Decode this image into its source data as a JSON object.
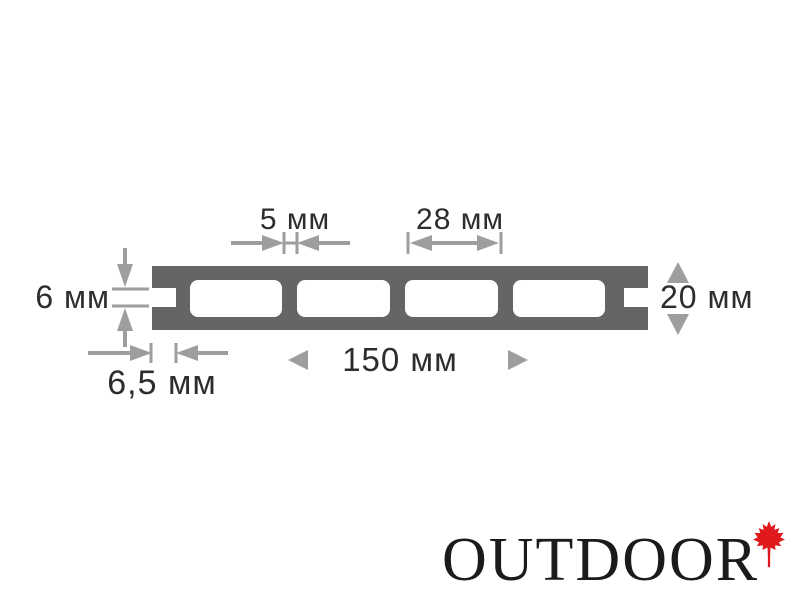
{
  "diagram": {
    "title_semantic": "decking-board-cross-section",
    "dim_labels": {
      "web_thickness": "5 мм",
      "chamber_width": "28 мм",
      "groove_height": "6 мм",
      "board_thickness": "20 мм",
      "board_width": "150 мм",
      "groove_depth": "6,5 мм"
    },
    "chambers_count": 4
  },
  "logo": {
    "text": "OUTDOOR",
    "icon": "maple-leaf"
  },
  "colors": {
    "board": "#656565",
    "dim": "#9e9e9e",
    "ink": "#2d2d2d",
    "leaf": "#e0191e",
    "logo": "#1b1b1b",
    "bg": "#ffffff"
  }
}
